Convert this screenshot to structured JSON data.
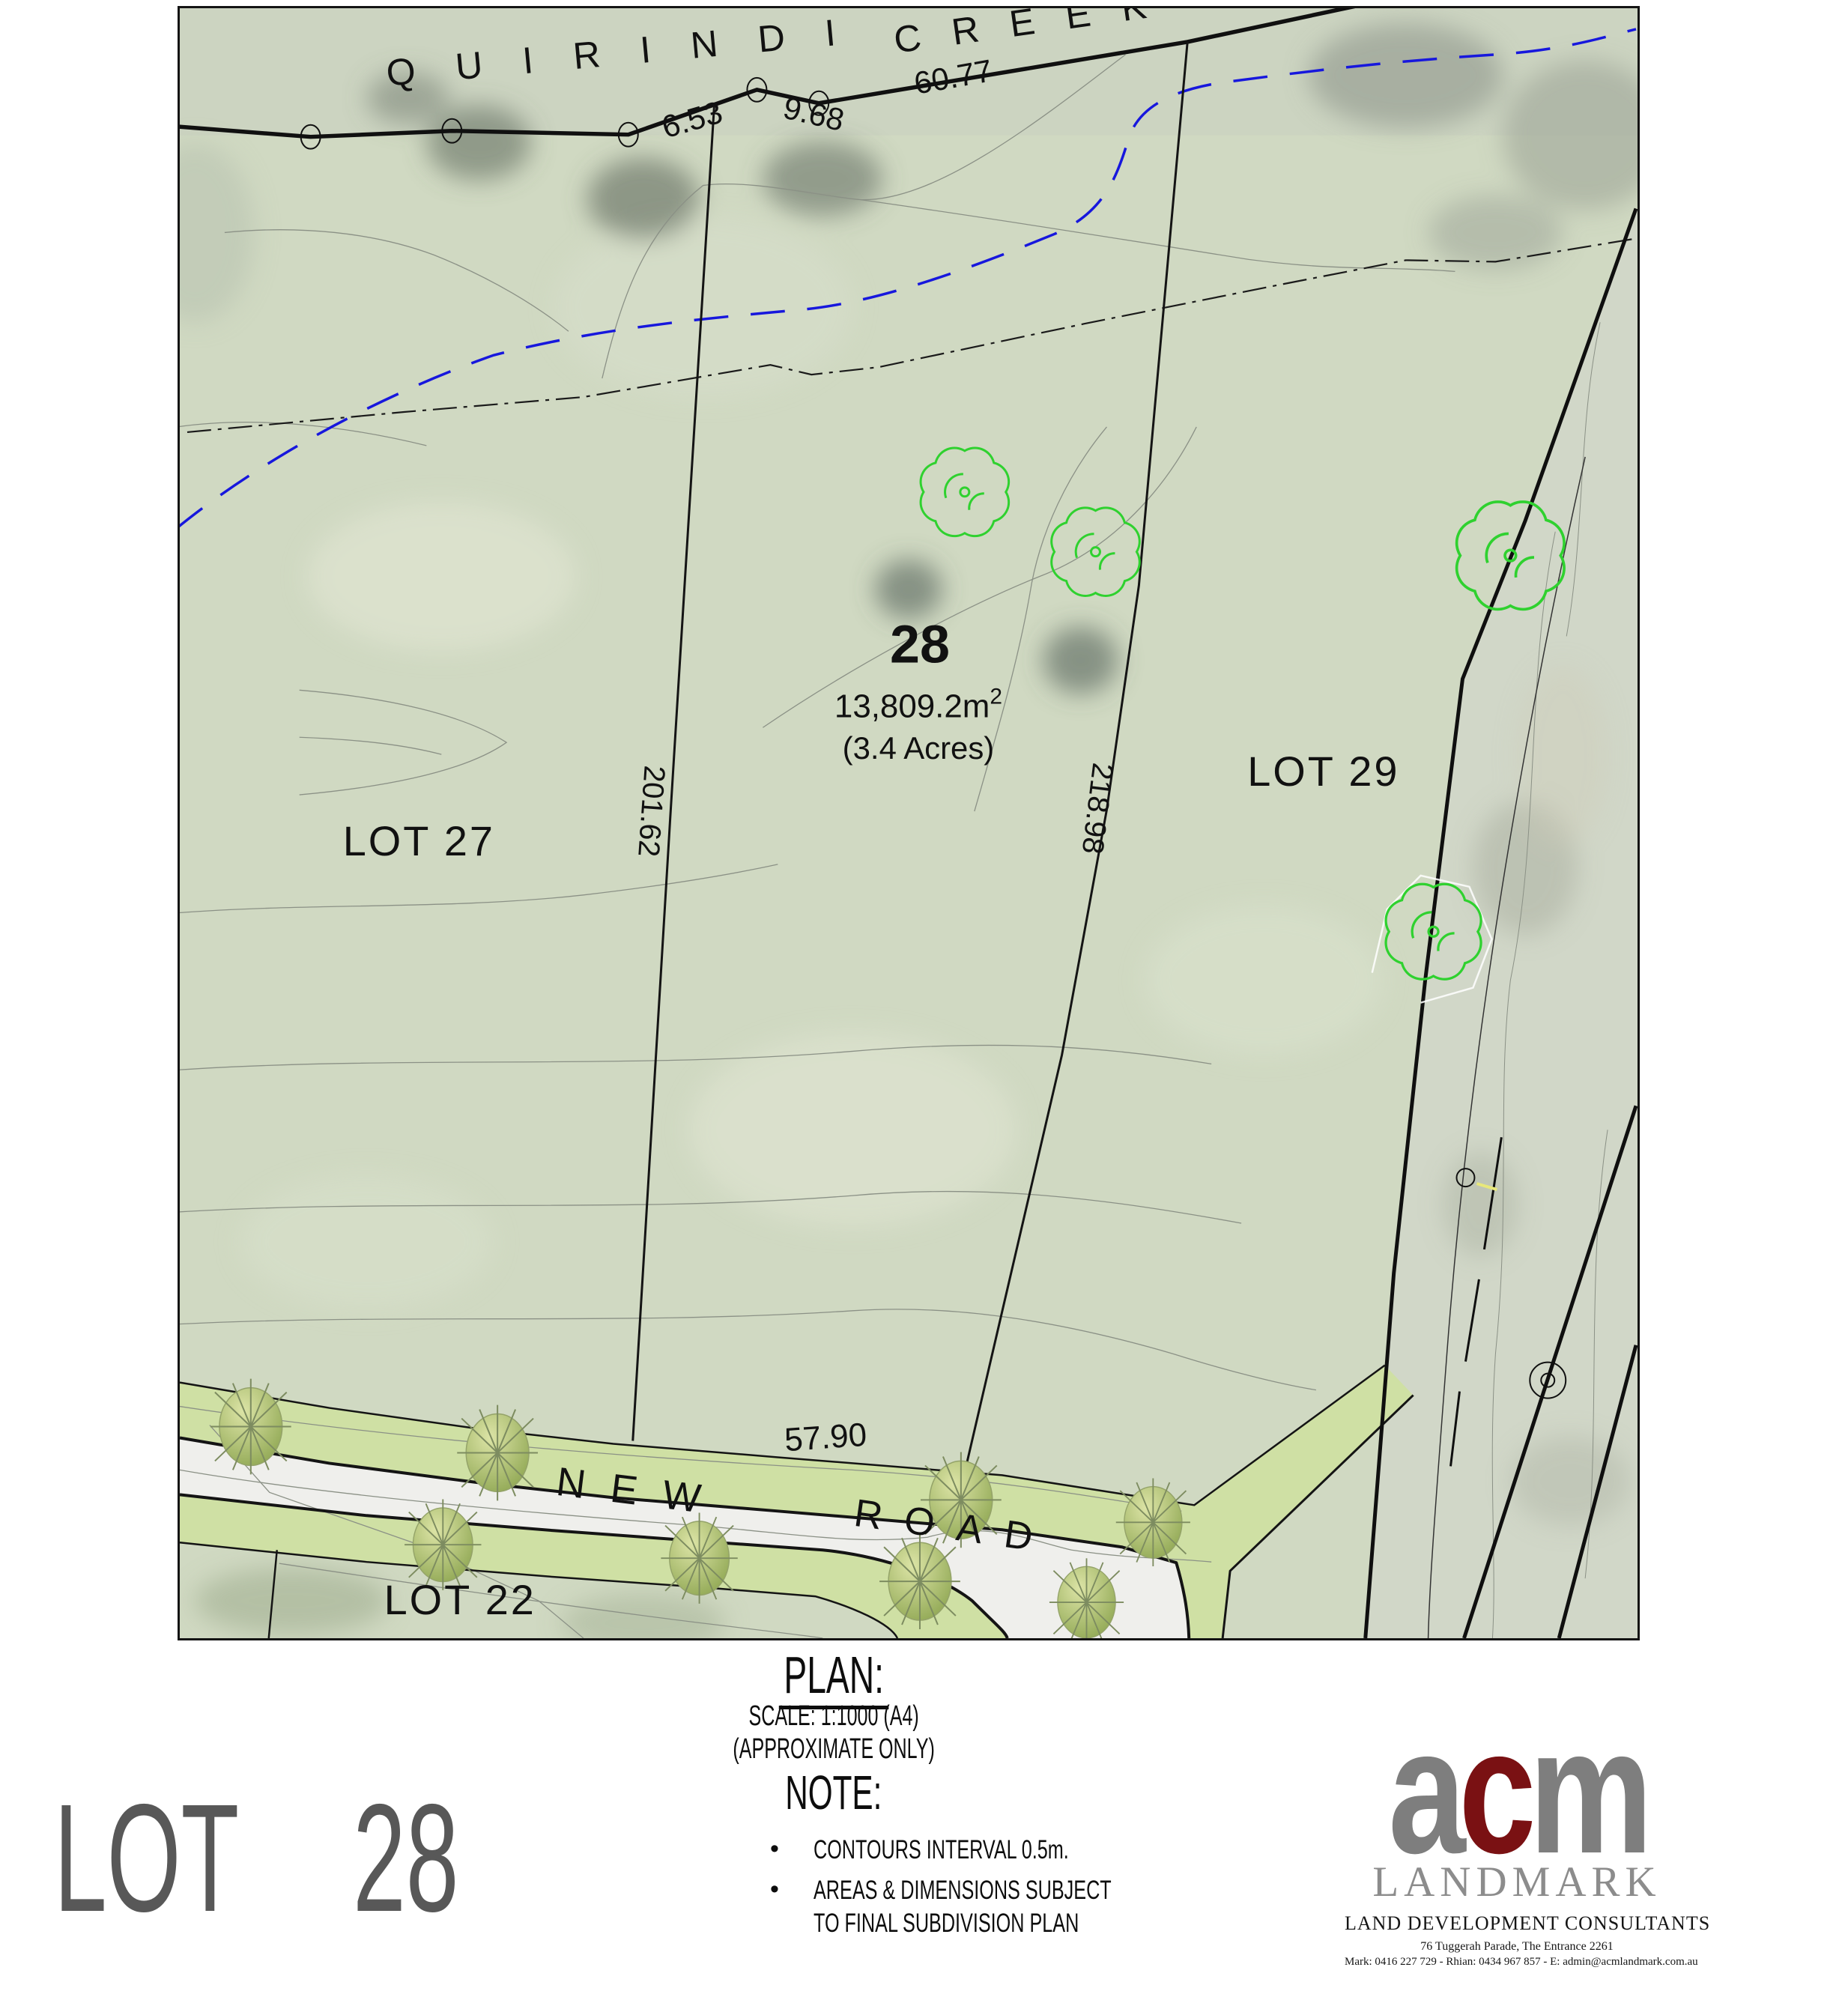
{
  "map": {
    "creek": {
      "word1": "QUIRINDI",
      "word2": "CREEK"
    },
    "dimensions": {
      "seg1": "6.53",
      "seg2": "9.68",
      "seg3": "60.77",
      "west_boundary": "201.62",
      "east_boundary": "218.98",
      "road_frontage": "57.90"
    },
    "lot28": {
      "number": "28",
      "area_main": "13,809.2m",
      "area_exp": "2",
      "acres": "(3.4 Acres)"
    },
    "adjacent_lots": {
      "lot27": "LOT 27",
      "lot29": "LOT 29",
      "lot22": "LOT 22"
    },
    "road": {
      "word1": "NEW",
      "word2": "ROAD"
    }
  },
  "plan_block": {
    "title": "PLAN:",
    "scale": "SCALE: 1:1000 (A4)",
    "approx": "(APPROXIMATE ONLY)"
  },
  "note_block": {
    "title": "NOTE:",
    "bullet_char": "•",
    "item1": "CONTOURS INTERVAL 0.5m.",
    "item2_line1": "AREAS & DIMENSIONS SUBJECT",
    "item2_line2": "TO FINAL SUBDIVISION PLAN"
  },
  "footer": {
    "lot_word": "LOT",
    "lot_number": "28"
  },
  "logo": {
    "letter_a": "a",
    "letter_c": "c",
    "letter_m": "m",
    "brand": "LANDMARK",
    "tagline": "LAND DEVELOPMENT CONSULTANTS",
    "address": "76 Tuggerah Parade, The Entrance 2261",
    "contact": "Mark: 0416 227 729 - Rhian: 0434 967 857 -  E: admin@acmlandmark.com.au"
  },
  "colors": {
    "map_base": "#d0d9c2",
    "verge_green": "#cfe0a4",
    "pavement": "#efefec",
    "creek_blue": "#1717dd",
    "tree_green": "#2fd12f",
    "lot_label_gray": "#8a8a8a",
    "logo_gray": "#7e7e7e",
    "logo_red": "#7a1113"
  }
}
